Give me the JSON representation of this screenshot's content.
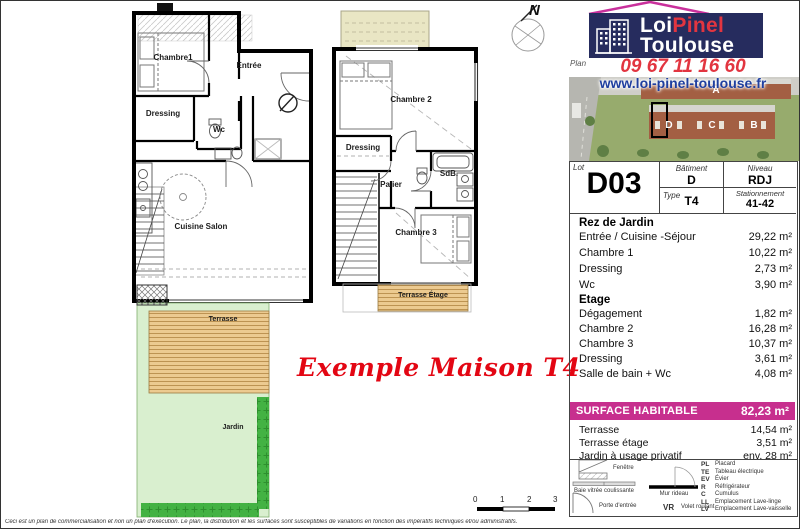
{
  "brand": {
    "logo_word1": "Loi",
    "logo_word2": "Pinel",
    "logo_word3": "Toulouse",
    "plan_label": "Plan",
    "phone": "09 67 11 16 60",
    "website": "www.loi-pinel-toulouse.fr",
    "navy": "#262c5e",
    "red": "#e23540",
    "blue": "#1f3f9f",
    "magenta": "#c72f8e"
  },
  "site_map": {
    "labels": [
      "A",
      "D",
      "C",
      "B"
    ]
  },
  "lot_table": {
    "lot_label": "Lot",
    "lot": "D03",
    "batiment_label": "Bâtiment",
    "batiment": "D",
    "niveau_label": "Niveau",
    "niveau": "RDJ",
    "type_label": "Type",
    "type": "T4",
    "stationnement_label": "Stationnement",
    "stationnement": "41-42"
  },
  "surfaces": {
    "rdj_title": "Rez de Jardin",
    "rdj": [
      {
        "label": "Entrée / Cuisine -Séjour",
        "value": "29,22 m²"
      },
      {
        "label": "Chambre 1",
        "value": "10,22 m²"
      },
      {
        "label": "Dressing",
        "value": "2,73 m²"
      },
      {
        "label": "Wc",
        "value": "3,90 m²"
      }
    ],
    "etage_title": "Etage",
    "etage": [
      {
        "label": "Dégagement",
        "value": "1,82 m²"
      },
      {
        "label": "Chambre 2",
        "value": "16,28 m²"
      },
      {
        "label": "Chambre 3",
        "value": "10,37 m²"
      },
      {
        "label": "Dressing",
        "value": "3,61 m²"
      },
      {
        "label": "Salle de bain + Wc",
        "value": "4,08 m²"
      }
    ],
    "habitable_label": "SURFACE HABITABLE",
    "habitable_value": "82,23 m²",
    "annexes": [
      {
        "label": "Terrasse",
        "value": "14,54 m²"
      },
      {
        "label": "Terrasse étage",
        "value": "3,51 m²"
      },
      {
        "label": "Jardin à usage privatif",
        "value": "env. 28 m²"
      }
    ]
  },
  "legend": {
    "symbols": [
      {
        "name": "fenetre",
        "label": "Fenêtre"
      },
      {
        "name": "baie-vitree",
        "label": "Baie vitrée coulissante"
      },
      {
        "name": "porte-entree",
        "label": "Porte d'entrée"
      },
      {
        "name": "mur-rideau",
        "label": "Mur rideau"
      },
      {
        "abbr": "VR",
        "label": "Volet roulant"
      }
    ],
    "abbreviations": [
      {
        "abbr": "PL",
        "label": "Placard"
      },
      {
        "abbr": "TE",
        "label": "Tableau électrique"
      },
      {
        "abbr": "EV",
        "label": "Évier"
      },
      {
        "abbr": "R",
        "label": "Réfrigérateur"
      },
      {
        "abbr": "C",
        "label": "Cumulus"
      },
      {
        "abbr": "LL",
        "label": "Emplacement Lave-linge"
      },
      {
        "abbr": "LV",
        "label": "Emplacement Lave-vaisselle"
      }
    ]
  },
  "plans": {
    "caption": "Exemple Maison T4",
    "compass": "N",
    "ground": {
      "chambre1": "Chambre1",
      "entree": "Entrée",
      "dressing": "Dressing",
      "wc": "Wc",
      "cuisine": "Cuisine Salon",
      "terrasse": "Terrasse",
      "jardin": "Jardin"
    },
    "upper": {
      "chambre2": "Chambre 2",
      "dressing": "Dressing",
      "palier": "Palier",
      "sdb": "SdB.",
      "chambre3": "Chambre 3",
      "terrasse": "Terrasse Étage"
    }
  },
  "scale": [
    "0",
    "1",
    "2",
    "3"
  ],
  "disclaimer": "Ceci est un plan de commercialisation et non un plan d'exécution. Le plan, la distribution et les surfaces sont susceptibles de variations en fonction des impératifs techniques et/ou administratifs."
}
